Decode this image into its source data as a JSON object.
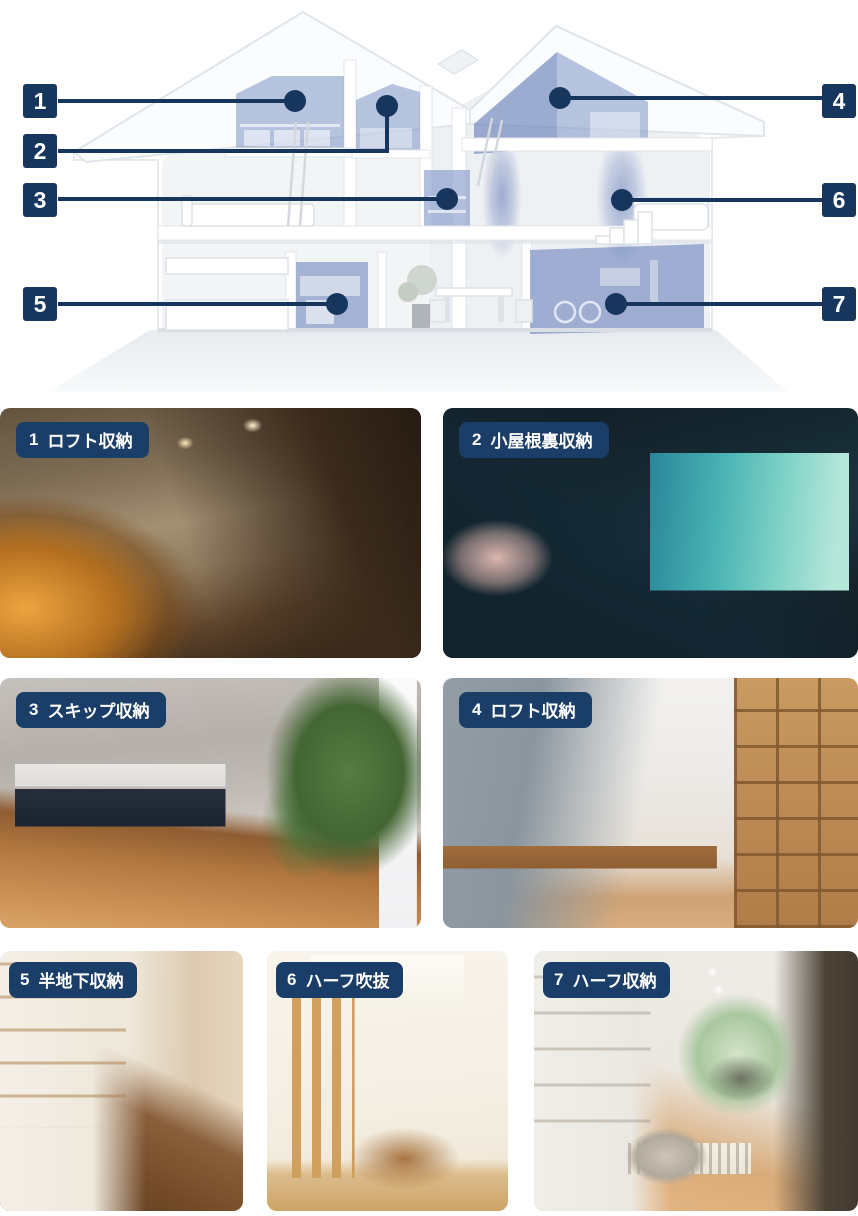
{
  "colors": {
    "navy": "#16365E",
    "label_navy": "#1B3E68",
    "highlight_blue": "#8DA2D2",
    "text_on_navy": "#FFFFFF"
  },
  "diagram": {
    "description_icons": "house-cutaway-with-numbered-storage-zones",
    "marker_numbers": [
      "1",
      "2",
      "3",
      "4",
      "5",
      "6",
      "7"
    ]
  },
  "cards": [
    {
      "number": "1",
      "title": "ロフト収納"
    },
    {
      "number": "2",
      "title": "小屋根裏収納"
    },
    {
      "number": "3",
      "title": "スキップ収納"
    },
    {
      "number": "4",
      "title": "ロフト収納"
    },
    {
      "number": "5",
      "title": "半地下収納"
    },
    {
      "number": "6",
      "title": "ハーフ吹抜"
    },
    {
      "number": "7",
      "title": "ハーフ収納"
    }
  ]
}
